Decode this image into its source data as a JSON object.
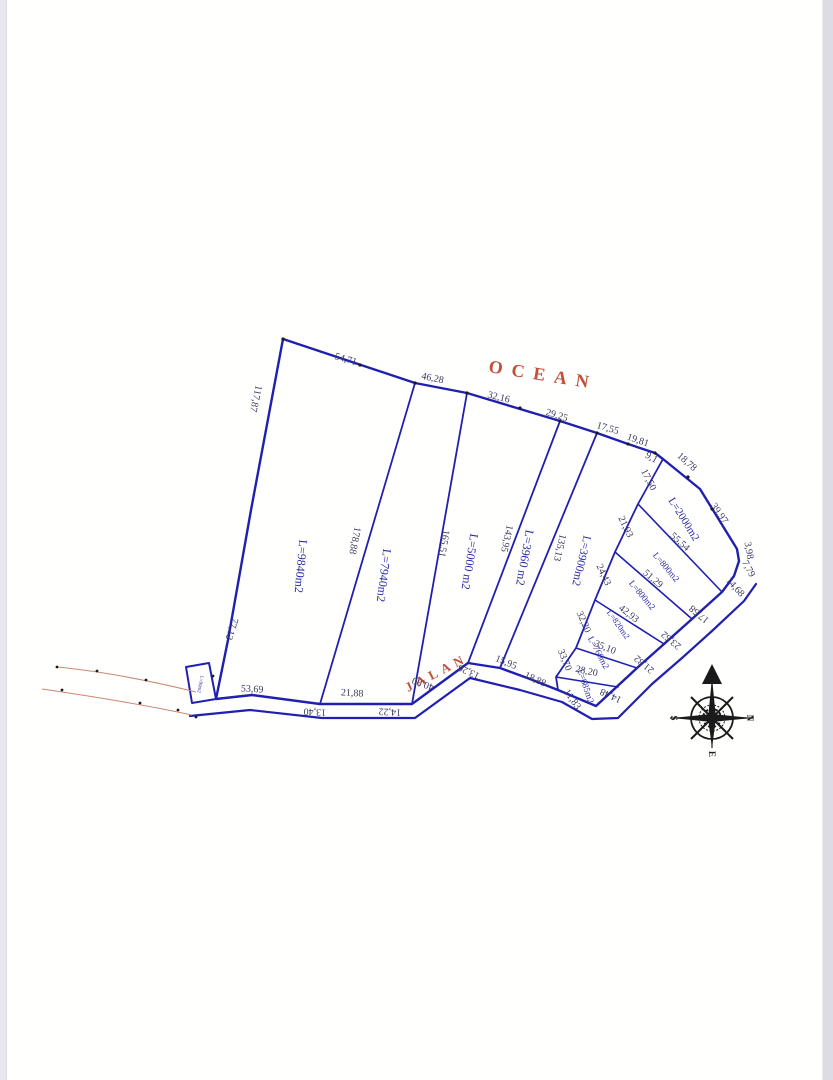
{
  "labels": {
    "ocean": "OCEAN",
    "road": "JALAN"
  },
  "compass": {
    "n": "N",
    "s": "S",
    "e": "E"
  },
  "parcels": [
    {
      "label": "L=9840m2"
    },
    {
      "label": "L=7940m2"
    },
    {
      "label": "L=5000 m2"
    },
    {
      "label": "L=3960 m2"
    },
    {
      "label": "L=3900m2"
    },
    {
      "label": "L=2000m2"
    },
    {
      "label": "L=800m2"
    },
    {
      "label": "L=800m2"
    },
    {
      "label": "L=820m2"
    },
    {
      "label": "L=760m2"
    },
    {
      "label": "L=685m2"
    },
    {
      "label": "L=90m2"
    }
  ],
  "m": {
    "top": [
      "54,71",
      "46,28",
      "32,16",
      "29,25",
      "17,55",
      "19,81",
      "9,1",
      "18,78"
    ],
    "east": [
      "39,97",
      "3,98",
      "7,79",
      "14,68"
    ],
    "se": [
      "17,58",
      "23,52",
      "21,82",
      "14,48"
    ],
    "west": [
      "117,87",
      "77,12"
    ],
    "bottom": [
      "53,69",
      "13,40",
      "21,88",
      "14,22",
      "40,00",
      "13,26",
      "15,95",
      "18,88",
      "11,83"
    ],
    "dividers": [
      "178,88",
      "165,51",
      "143,95",
      "135,13"
    ],
    "cluster_left": [
      "17,50",
      "21,93",
      "24,43",
      "32,20",
      "33,70"
    ],
    "cluster_cross": [
      "55,54",
      "51,29",
      "42,93",
      "35,10",
      "28,20"
    ]
  },
  "colors": {
    "parcel_line": "#2020b0",
    "parcel_text": "#2a2aa6",
    "measure_text": "#3a3a5e",
    "sea_road_text": "#c0503c",
    "red_line": "#cc8874",
    "compass": "#1a1a1a"
  }
}
